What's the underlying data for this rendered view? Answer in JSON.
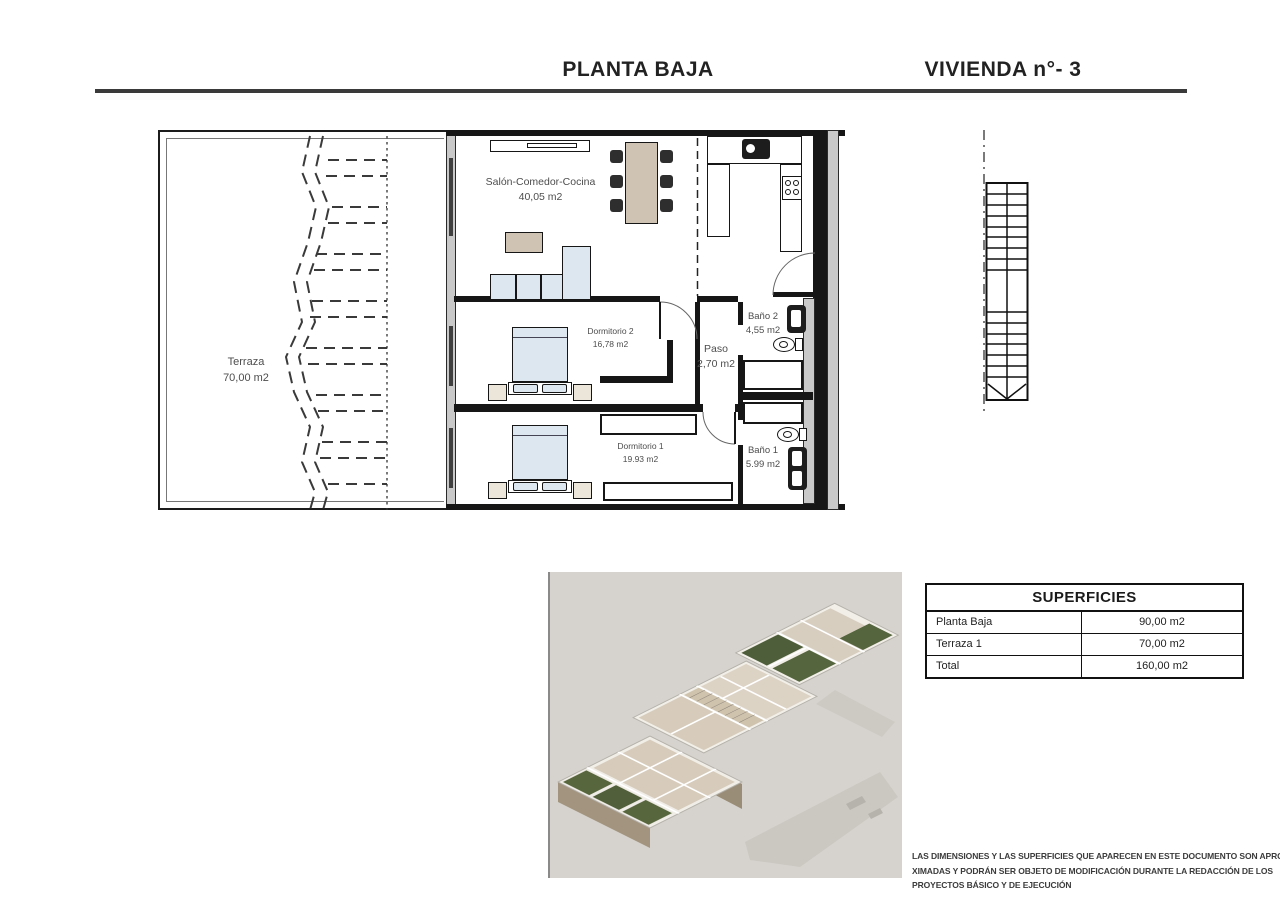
{
  "header": {
    "left_title": "PLANTA BAJA",
    "right_title": "VIVIENDA n°- 3"
  },
  "floorplan": {
    "rooms": {
      "terraza": {
        "name": "Terraza",
        "area": "70,00 m2"
      },
      "salon": {
        "name": "Salón-Comedor-Cocina",
        "area": "40,05 m2"
      },
      "dormitorio2": {
        "name": "Dormitorio 2",
        "area": "16,78 m2"
      },
      "paso": {
        "name": "Paso",
        "area": "2,70 m2"
      },
      "bano2": {
        "name": "Baño 2",
        "area": "4,55 m2"
      },
      "dormitorio1": {
        "name": "Dormitorio 1",
        "area": "19.93 m2"
      },
      "bano1": {
        "name": "Baño 1",
        "area": "5.99 m2"
      }
    }
  },
  "superficies_table": {
    "title": "SUPERFICIES",
    "rows": [
      {
        "label": "Planta Baja",
        "value": "90,00 m2"
      },
      {
        "label": "Terraza 1",
        "value": "70,00 m2"
      },
      {
        "label": "Total",
        "value": "160,00 m2"
      }
    ]
  },
  "disclaimer": {
    "line1": "LAS DIMENSIONES Y LAS SUPERFICIES QUE APARECEN EN ESTE DOCUMENTO SON APRO-",
    "line2": "XIMADAS Y PODRÁN SER OBJETO DE MODIFICACIÓN DURANTE LA REDACCIÓN DE LOS",
    "line3": "PROYECTOS BÁSICO Y DE EJECUCIÓN"
  },
  "colors": {
    "line_dark": "#161616",
    "furniture_beige": "#cfc4b4",
    "furniture_blue": "#dde7ef",
    "render_background": "#d6d3ce",
    "garden_green": "#57663c"
  }
}
